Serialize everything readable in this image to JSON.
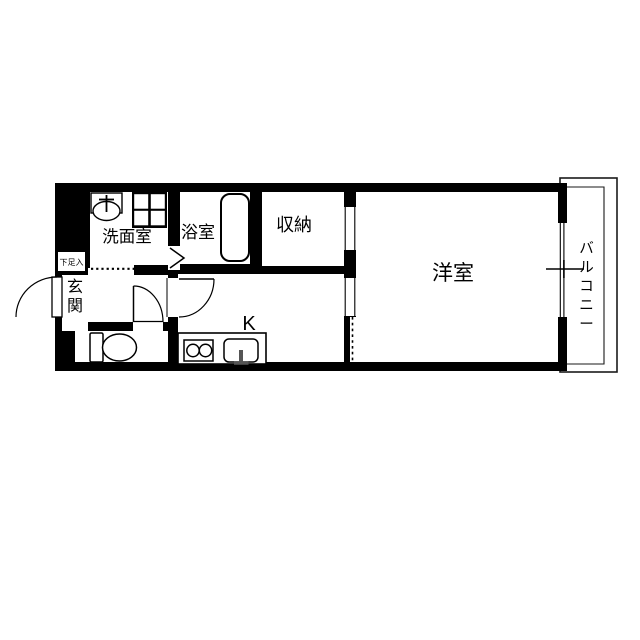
{
  "type": "japanese-apartment-floor-plan",
  "rooms": {
    "washroom": {
      "label": "洗面室"
    },
    "bathroom": {
      "label": "浴室"
    },
    "storage": {
      "label": "収納"
    },
    "western_room": {
      "label": "洋室"
    },
    "kitchen": {
      "label": "K"
    },
    "entrance": {
      "label": "玄関"
    },
    "shoe_storage": {
      "label": "下足入"
    },
    "balcony": {
      "label": "バルコニー"
    }
  },
  "icons": {
    "sink": "washbasin-icon",
    "washing_machine_pan": "washing-machine-pan-icon",
    "bathtub": "bathtub-icon",
    "toilet": "toilet-icon",
    "stove": "two-burner-stove-icon",
    "kitchen_sink": "kitchen-sink-icon",
    "doors": "door-swing-arc",
    "bath_door": "folding-door-chevron",
    "window": "sliding-window"
  },
  "colors": {
    "wall": "#000000",
    "background": "#ffffff",
    "line": "#1a1a1a",
    "fixture_accent": "#555555"
  }
}
